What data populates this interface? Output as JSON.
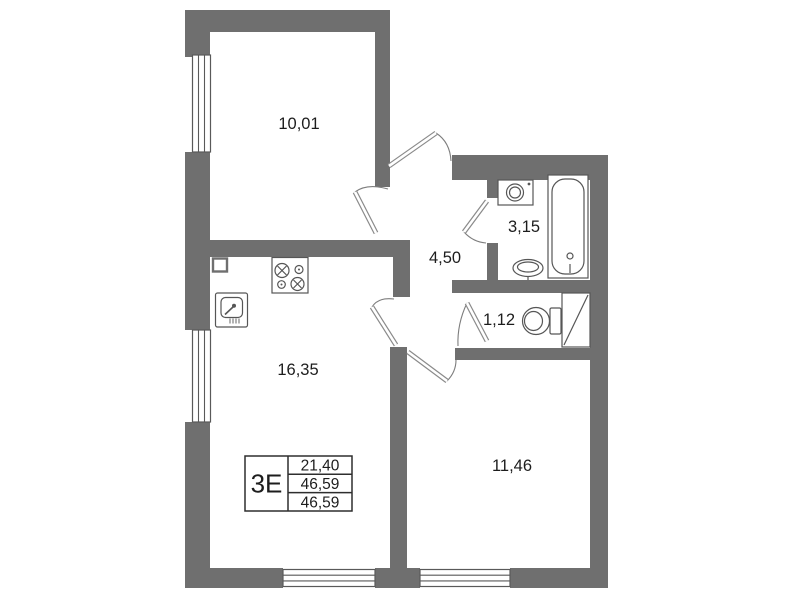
{
  "plan": {
    "rooms": [
      {
        "id": "room-top-left",
        "area": "10,01"
      },
      {
        "id": "hallway",
        "area": "4,50"
      },
      {
        "id": "bathroom",
        "area": "3,15"
      },
      {
        "id": "wc",
        "area": "1,12"
      },
      {
        "id": "kitchen-living-room",
        "area": "16,35"
      },
      {
        "id": "bedroom",
        "area": "11,46"
      }
    ],
    "legend": {
      "type_label": "3Е",
      "values": [
        "21,40",
        "46,59",
        "46,59"
      ]
    },
    "fixtures": [
      "washing-machine",
      "bathtub",
      "wash-basin",
      "toilet",
      "ventilation-shaft",
      "stove",
      "kitchen-sink"
    ],
    "colors": {
      "wall": "#6f6f6f",
      "fixture_line": "#565656",
      "text": "#1d1d1d",
      "background": "#ffffff"
    }
  }
}
